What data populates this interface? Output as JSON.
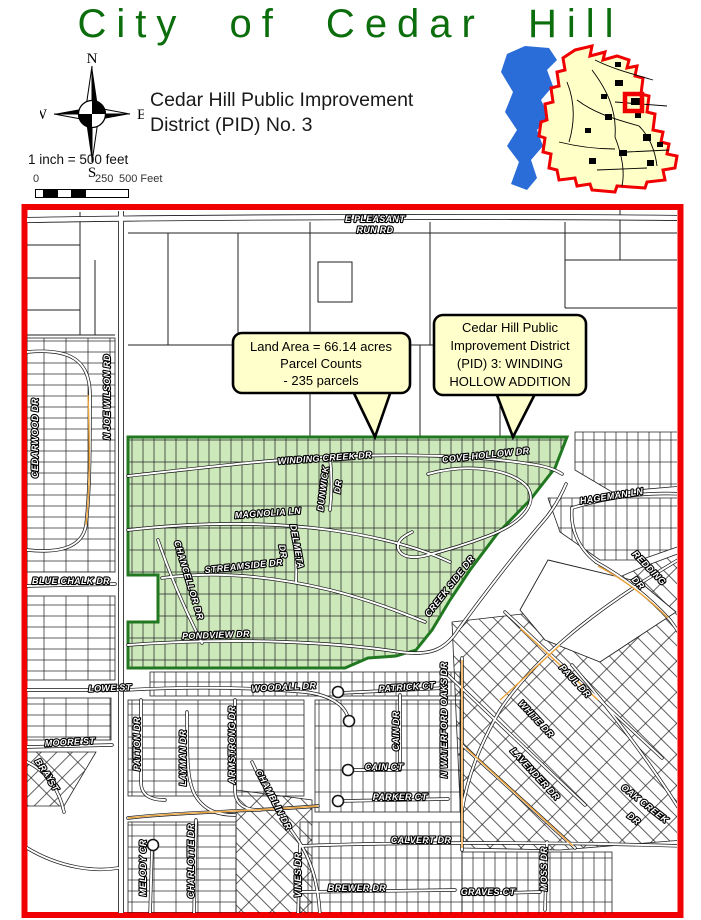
{
  "header": {
    "title": "City of Cedar Hill",
    "title_color": "#0b6d0b",
    "subtitle_line1": "Cedar Hill Public Improvement",
    "subtitle_line2": "District (PID) No. 3",
    "scale_text": "1 inch = 500 feet",
    "scalebar": {
      "tick0": "0",
      "tick250": "250",
      "tick500": "500 Feet"
    },
    "compass": {
      "n": "N",
      "s": "S",
      "e": "E",
      "w": "W"
    }
  },
  "inset": {
    "lake_color": "#2a6cd8",
    "city_fill": "#ffffc8",
    "boundary_color": "#f00000",
    "marker_color": "#f00000"
  },
  "map": {
    "border_color": "#f00000",
    "district_fill": "#cde9bc",
    "district_border": "#217821",
    "callouts": [
      {
        "lines": [
          "Land Area = 66.14 acres",
          "Parcel Counts",
          "- 235 parcels"
        ]
      },
      {
        "lines": [
          "Cedar Hill Public",
          "Improvement District",
          "(PID) 3: WINDING",
          "HOLLOW ADDITION"
        ]
      }
    ],
    "street_labels": [
      {
        "text": "E PLEASANT",
        "x": 375,
        "y": 222,
        "r": 0
      },
      {
        "text": "RUN RD",
        "x": 375,
        "y": 233,
        "r": 0
      },
      {
        "text": "N JOE WILSON RD",
        "x": 110,
        "y": 397,
        "r": -90
      },
      {
        "text": "CEDARWOOD DR",
        "x": 38,
        "y": 438,
        "r": -90
      },
      {
        "text": "BLUE CHALK DR",
        "x": 71,
        "y": 584,
        "r": 0
      },
      {
        "text": "WINDING CREEK DR",
        "x": 325,
        "y": 461,
        "r": -4
      },
      {
        "text": "DUNWICK",
        "x": 326,
        "y": 489,
        "r": -83
      },
      {
        "text": "DR",
        "x": 341,
        "y": 487,
        "r": -83
      },
      {
        "text": "MAGNOLIA LN",
        "x": 268,
        "y": 516,
        "r": -4
      },
      {
        "text": "DELMETA",
        "x": 294,
        "y": 547,
        "r": 80
      },
      {
        "text": "DR",
        "x": 280,
        "y": 552,
        "r": 80
      },
      {
        "text": "STREAMSIDE DR",
        "x": 244,
        "y": 569,
        "r": -6
      },
      {
        "text": "CHANCELLOR DR",
        "x": 186,
        "y": 581,
        "r": 73
      },
      {
        "text": "PONDVIEW DR",
        "x": 216,
        "y": 638,
        "r": -2
      },
      {
        "text": "COVE HOLLOW DR",
        "x": 486,
        "y": 458,
        "r": -6
      },
      {
        "text": "CREEK SIDE DR",
        "x": 452,
        "y": 588,
        "r": -52
      },
      {
        "text": "HAGEMAN LN",
        "x": 612,
        "y": 499,
        "r": -9
      },
      {
        "text": "REDDING",
        "x": 647,
        "y": 570,
        "r": 46
      },
      {
        "text": "DR",
        "x": 636,
        "y": 585,
        "r": 46
      },
      {
        "text": "LOWE ST",
        "x": 110,
        "y": 691,
        "r": -2
      },
      {
        "text": "WOODALL DR",
        "x": 284,
        "y": 690,
        "r": -3
      },
      {
        "text": "PATRICK CT",
        "x": 407,
        "y": 690,
        "r": -4
      },
      {
        "text": "MOORE ST",
        "x": 70,
        "y": 745,
        "r": -3
      },
      {
        "text": "BRAY",
        "x": 42,
        "y": 772,
        "r": 55
      },
      {
        "text": "ST",
        "x": 51,
        "y": 787,
        "r": 55
      },
      {
        "text": "PATTON DR",
        "x": 140,
        "y": 744,
        "r": -90
      },
      {
        "text": "LAYMAN DR",
        "x": 186,
        "y": 758,
        "r": -90
      },
      {
        "text": "ARMSTRONG DR",
        "x": 235,
        "y": 745,
        "r": -90
      },
      {
        "text": "CAIN DR",
        "x": 399,
        "y": 731,
        "r": -90
      },
      {
        "text": "CAIN CT",
        "x": 384,
        "y": 770,
        "r": 0
      },
      {
        "text": "N WATERFORD OAKS DR",
        "x": 447,
        "y": 720,
        "r": -90
      },
      {
        "text": "PARKER CT",
        "x": 400,
        "y": 800,
        "r": 0
      },
      {
        "text": "CHAMBLIN DR",
        "x": 271,
        "y": 801,
        "r": 62
      },
      {
        "text": "MELODY CR",
        "x": 146,
        "y": 868,
        "r": -90
      },
      {
        "text": "CHARLOTTE DR",
        "x": 194,
        "y": 861,
        "r": -90
      },
      {
        "text": "VINES DR",
        "x": 301,
        "y": 875,
        "r": -90
      },
      {
        "text": "CALVERT DR",
        "x": 421,
        "y": 843,
        "r": 0
      },
      {
        "text": "BREWER DR",
        "x": 357,
        "y": 891,
        "r": 0
      },
      {
        "text": "GRAVES CT",
        "x": 488,
        "y": 895,
        "r": 0
      },
      {
        "text": "MOSS DR",
        "x": 547,
        "y": 869,
        "r": -90
      },
      {
        "text": "PAUL DR",
        "x": 573,
        "y": 683,
        "r": 47
      },
      {
        "text": "WHITE DR",
        "x": 534,
        "y": 721,
        "r": 47
      },
      {
        "text": "LAVENDER DR",
        "x": 533,
        "y": 776,
        "r": 47
      },
      {
        "text": "OAK CREEK",
        "x": 643,
        "y": 806,
        "r": 38
      },
      {
        "text": "DR",
        "x": 632,
        "y": 821,
        "r": 38
      }
    ]
  }
}
